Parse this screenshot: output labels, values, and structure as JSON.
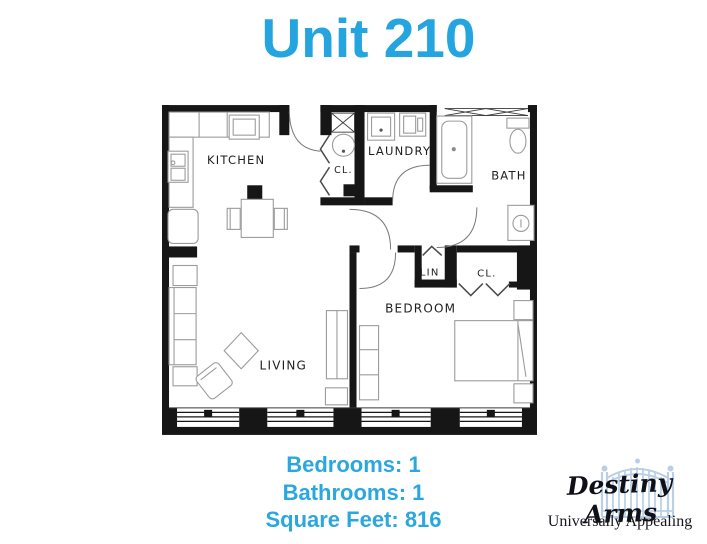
{
  "title": "Unit 210",
  "colors": {
    "accent_blue": "#25a5e0",
    "stats_blue": "#2ba7e0",
    "wall_black": "#161616",
    "gate_blue": "#b9cfe8"
  },
  "floor_plan": {
    "rooms": {
      "kitchen": "KITCHEN",
      "utility_closet": "CL.",
      "laundry": "LAUNDRY",
      "bath": "BATH",
      "linen": "LIN",
      "bedroom_closet": "CL.",
      "bedroom": "BEDROOM",
      "living": "LIVING"
    }
  },
  "stats": {
    "bedrooms": "Bedrooms: 1",
    "bathrooms": "Bathrooms: 1",
    "square_feet": "Square Feet: 816"
  },
  "logo": {
    "brand": "Destiny Arms",
    "tagline": "Universally Appealing"
  }
}
